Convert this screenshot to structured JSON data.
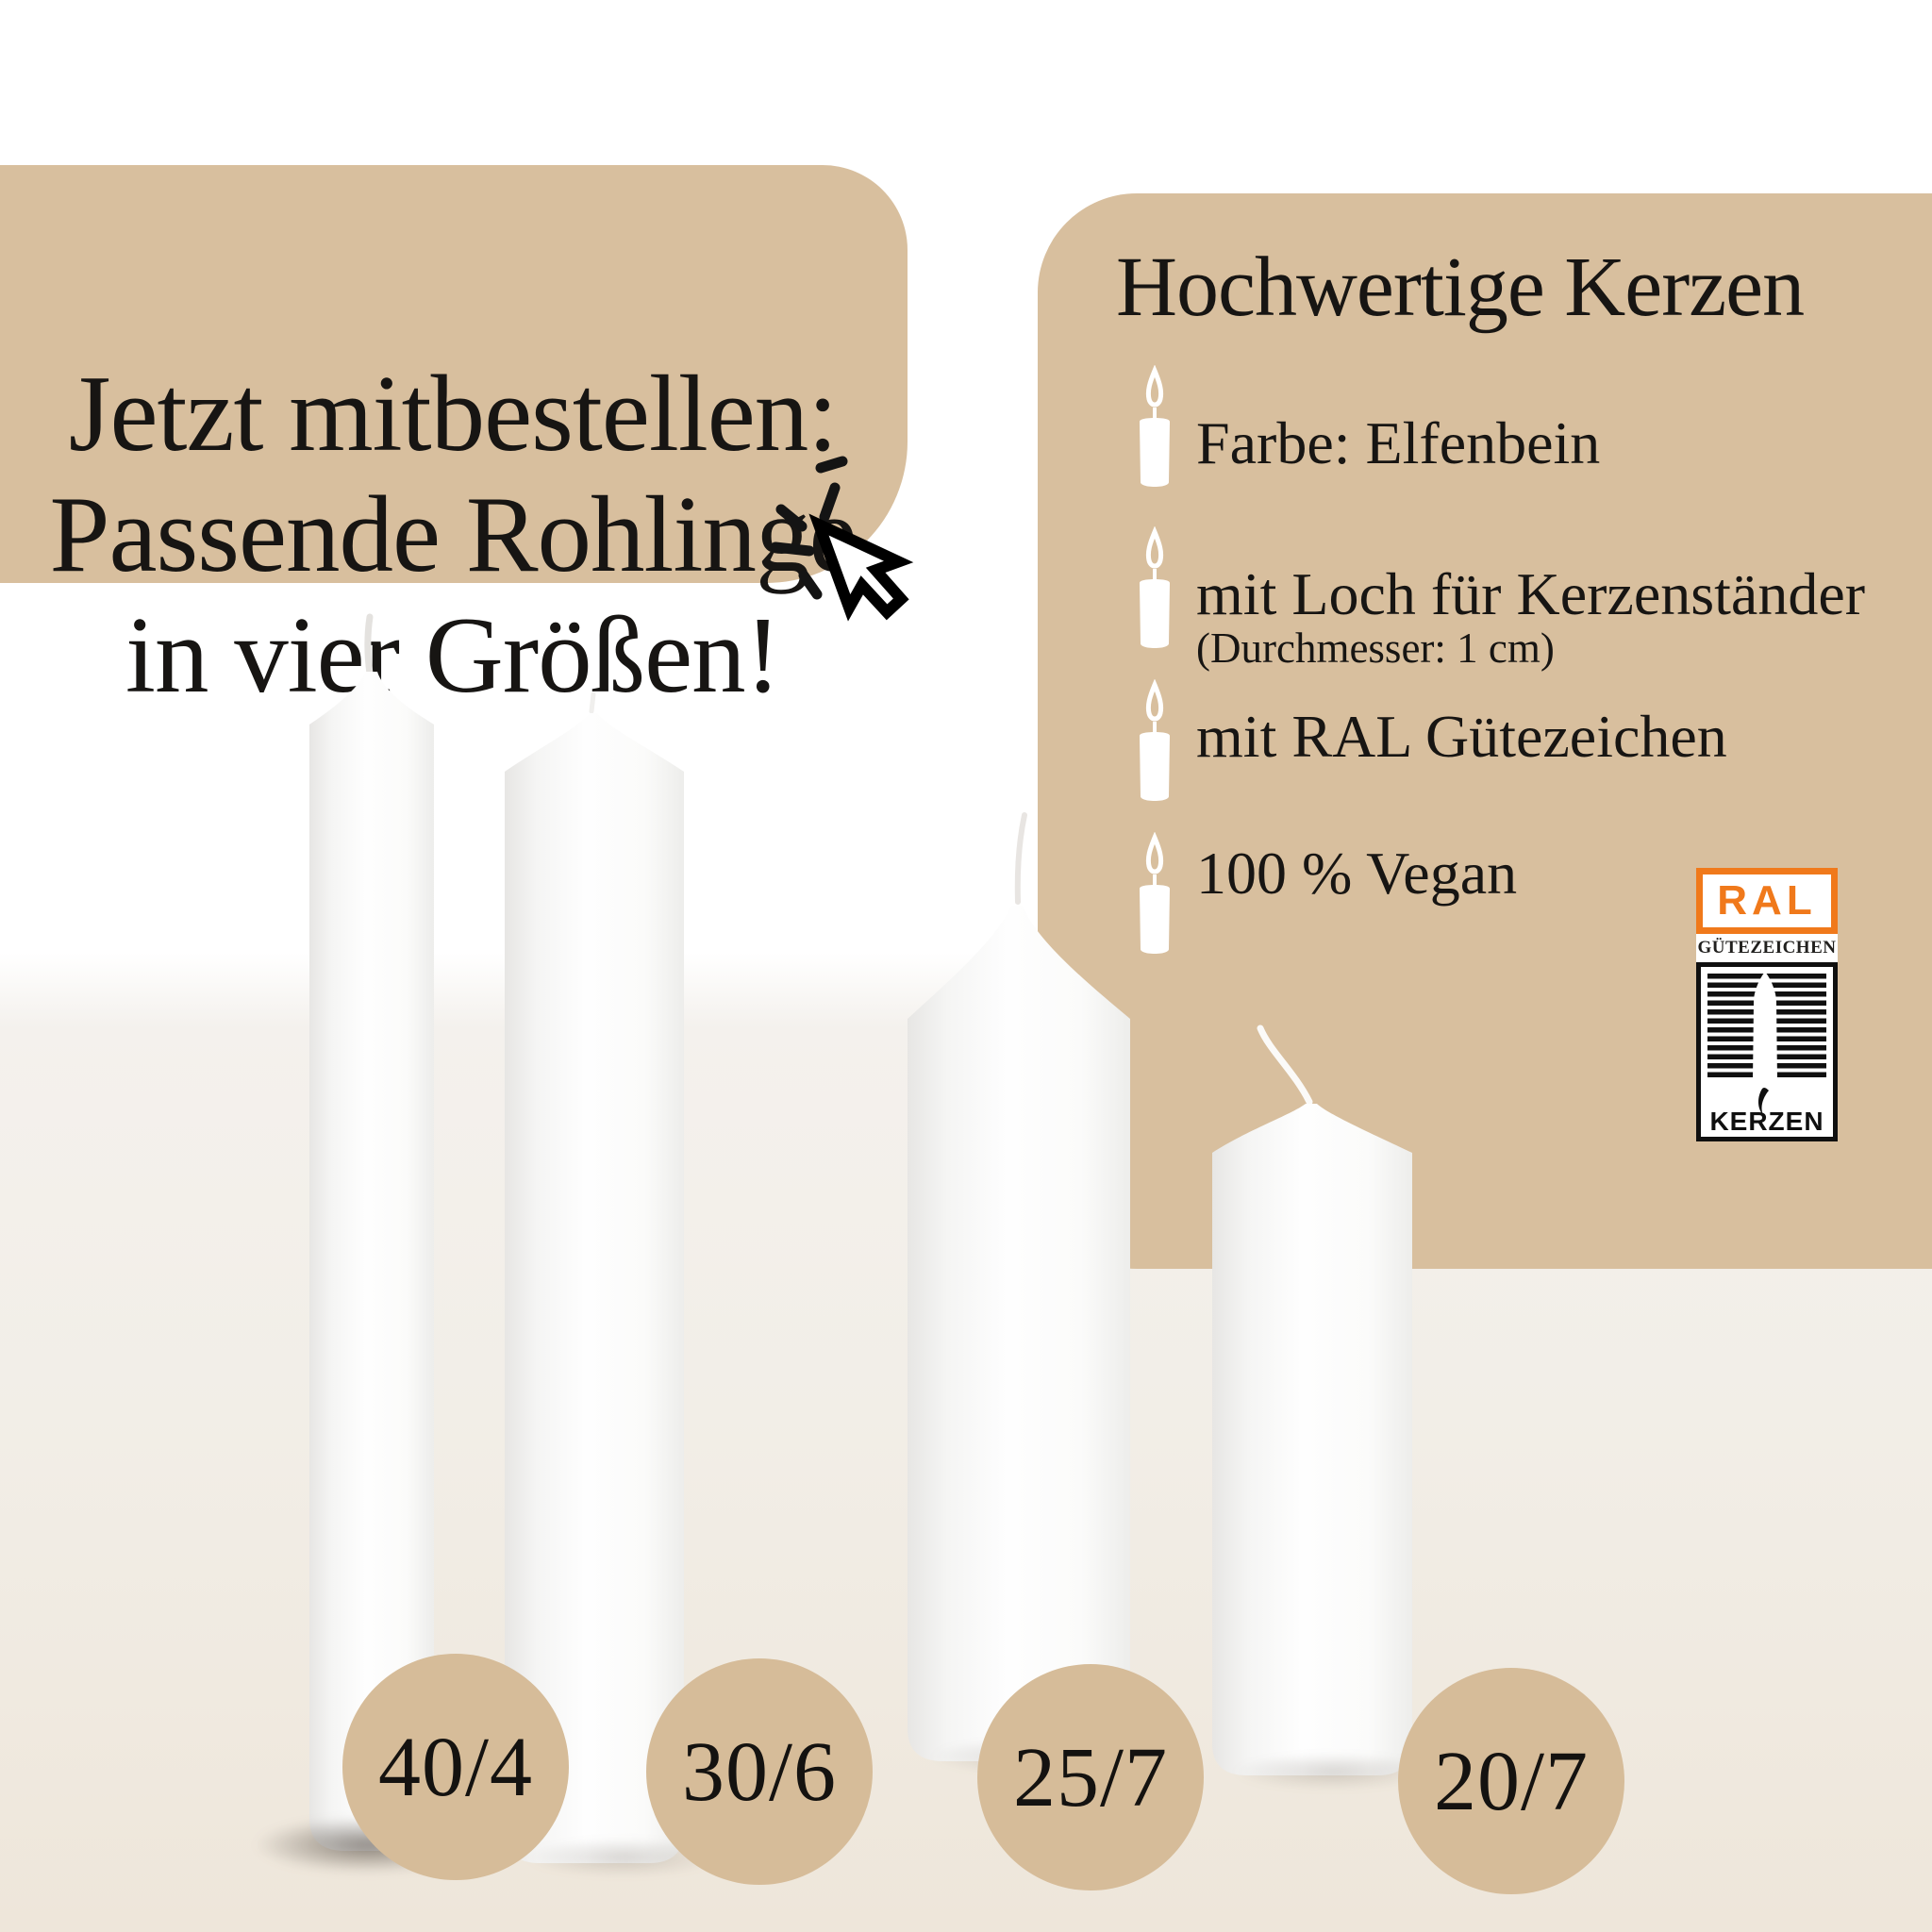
{
  "left_banner": {
    "lines": [
      "Jetzt mitbestellen:",
      "Passende Rohlinge",
      "in vier Größen!"
    ]
  },
  "right_panel": {
    "title": "Hochwertige Kerzen",
    "bullets": [
      {
        "text": "Farbe: Elfenbein",
        "subtext": ""
      },
      {
        "text": "mit Loch für Kerzenständer",
        "subtext": "(Durchmesser: 1 cm)"
      },
      {
        "text": "mit RAL Gütezeichen",
        "subtext": ""
      },
      {
        "text": "100 % Vegan",
        "subtext": ""
      }
    ]
  },
  "ral_badge": {
    "brand": "RAL",
    "subtitle": "GÜTEZEICHEN",
    "footer": "KERZEN"
  },
  "size_labels": [
    "40/4",
    "30/6",
    "25/7",
    "20/7"
  ],
  "icons": {
    "bullet": "candle-with-flame-icon",
    "cursor": "mouse-click-cursor-icon"
  },
  "colors": {
    "tan": "#d8bf9e",
    "circle_tan": "#d6bc99",
    "text": "#171513",
    "ral_orange": "#f0791b",
    "candle_white": "#fdfdfd"
  }
}
